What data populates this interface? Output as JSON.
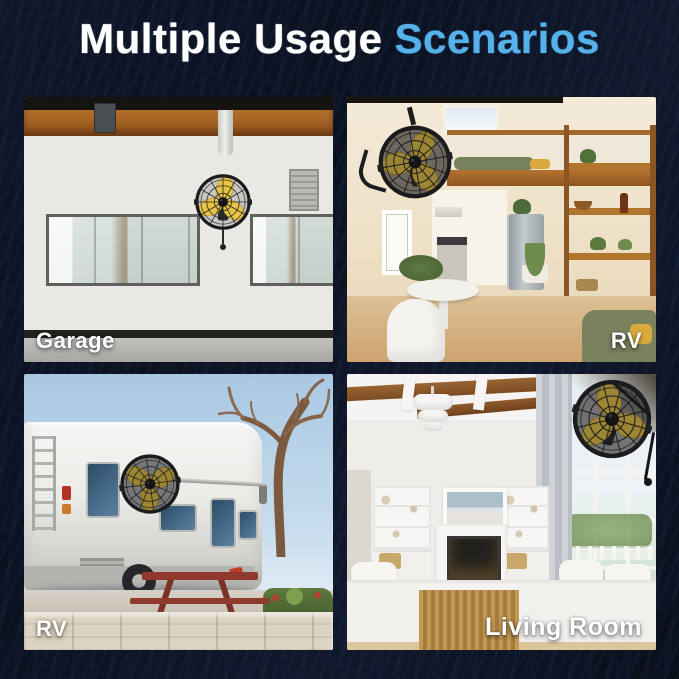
{
  "title": {
    "text_white": "Multiple Usage",
    "text_accent": "Scenarios",
    "full": "Multiple Usage Scenarios"
  },
  "colors": {
    "background": "#0a0e19",
    "accent_blue": "#55b1e9",
    "title_white": "#ffffff",
    "label_white": "#ffffff",
    "fan_blade_yellow": "#e6c445",
    "fan_cage_black": "#1b1b1e"
  },
  "product": {
    "item": "wall-mounted fan",
    "blade_color_name": "yellow",
    "cage_color_name": "black"
  },
  "panels": [
    {
      "id": "garage",
      "label": "Garage",
      "label_position": "bottom-left",
      "scene": "garage interior with wall-mounted fan"
    },
    {
      "id": "rv-interior",
      "label": "RV",
      "label_position": "bottom-right",
      "scene": "tiny-home RV interior with wall-mounted fan"
    },
    {
      "id": "rv-exterior",
      "label": "RV",
      "label_position": "bottom-left",
      "scene": "motorhome exterior with mounted fan"
    },
    {
      "id": "living-room",
      "label": "Living Room",
      "label_position": "bottom-right",
      "scene": "living room with wall-mounted fan"
    }
  ]
}
